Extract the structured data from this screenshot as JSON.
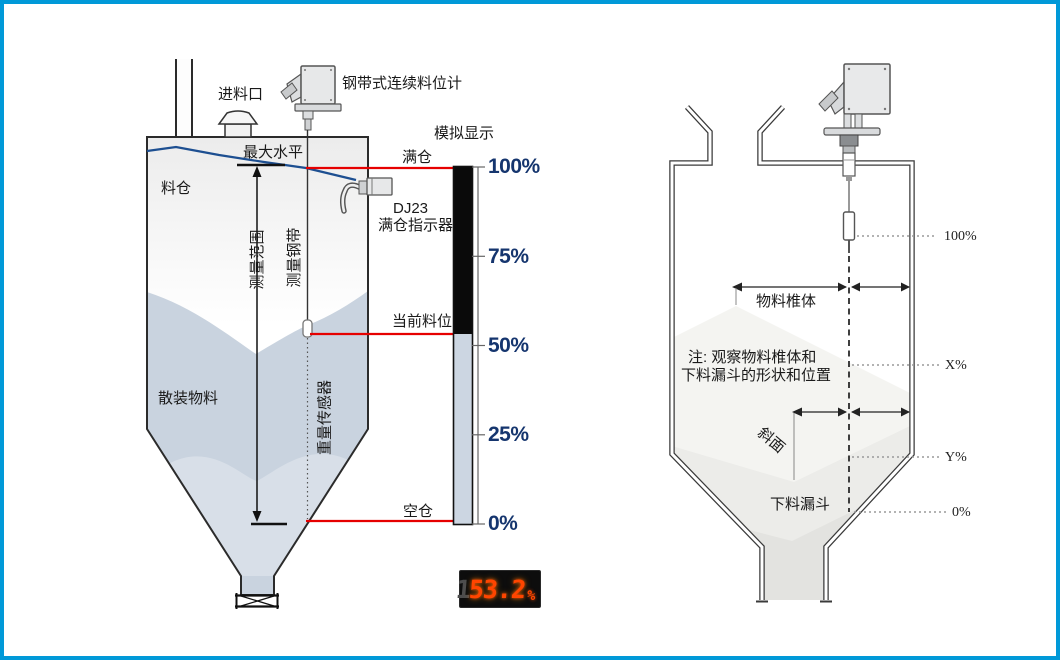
{
  "left": {
    "device_label": "钢带式连续料位计",
    "inlet": "进料口",
    "max_level": "最大水平",
    "silo": "料仓",
    "full": "满仓",
    "dj23_model": "DJ23",
    "dj23_name": "满仓指示器",
    "range": "测量范围",
    "tape": "测量钢带",
    "current": "当前料位",
    "bulk": "散装物料",
    "weight_sensor": "重量传感器",
    "empty": "空仓"
  },
  "gauge": {
    "title": "模拟显示",
    "ticks": [
      "100%",
      "75%",
      "50%",
      "25%",
      "0%"
    ],
    "fill_percent": 53.2
  },
  "display": {
    "ghost_digit": "1",
    "value": "53.2",
    "unit": "%"
  },
  "right": {
    "cone": "物料椎体",
    "note_line1": "注: 观察物料椎体和",
    "note_line2": "下料漏斗的形状和位置",
    "slope": "斜面",
    "funnel": "下料漏斗",
    "mark_100": "100%",
    "mark_x": "X%",
    "mark_y": "Y%",
    "mark_0": "0%"
  },
  "colors": {
    "frame_blue": "#0099d8",
    "accent_red": "#e60000",
    "level_blue": "#1d4f91",
    "tick_navy": "#15356e",
    "material_blue_gray": "#c9d3df",
    "display_red": "#ff4500",
    "gauge_black": "#0a0a0a",
    "gauge_light": "#ccd6e2"
  }
}
